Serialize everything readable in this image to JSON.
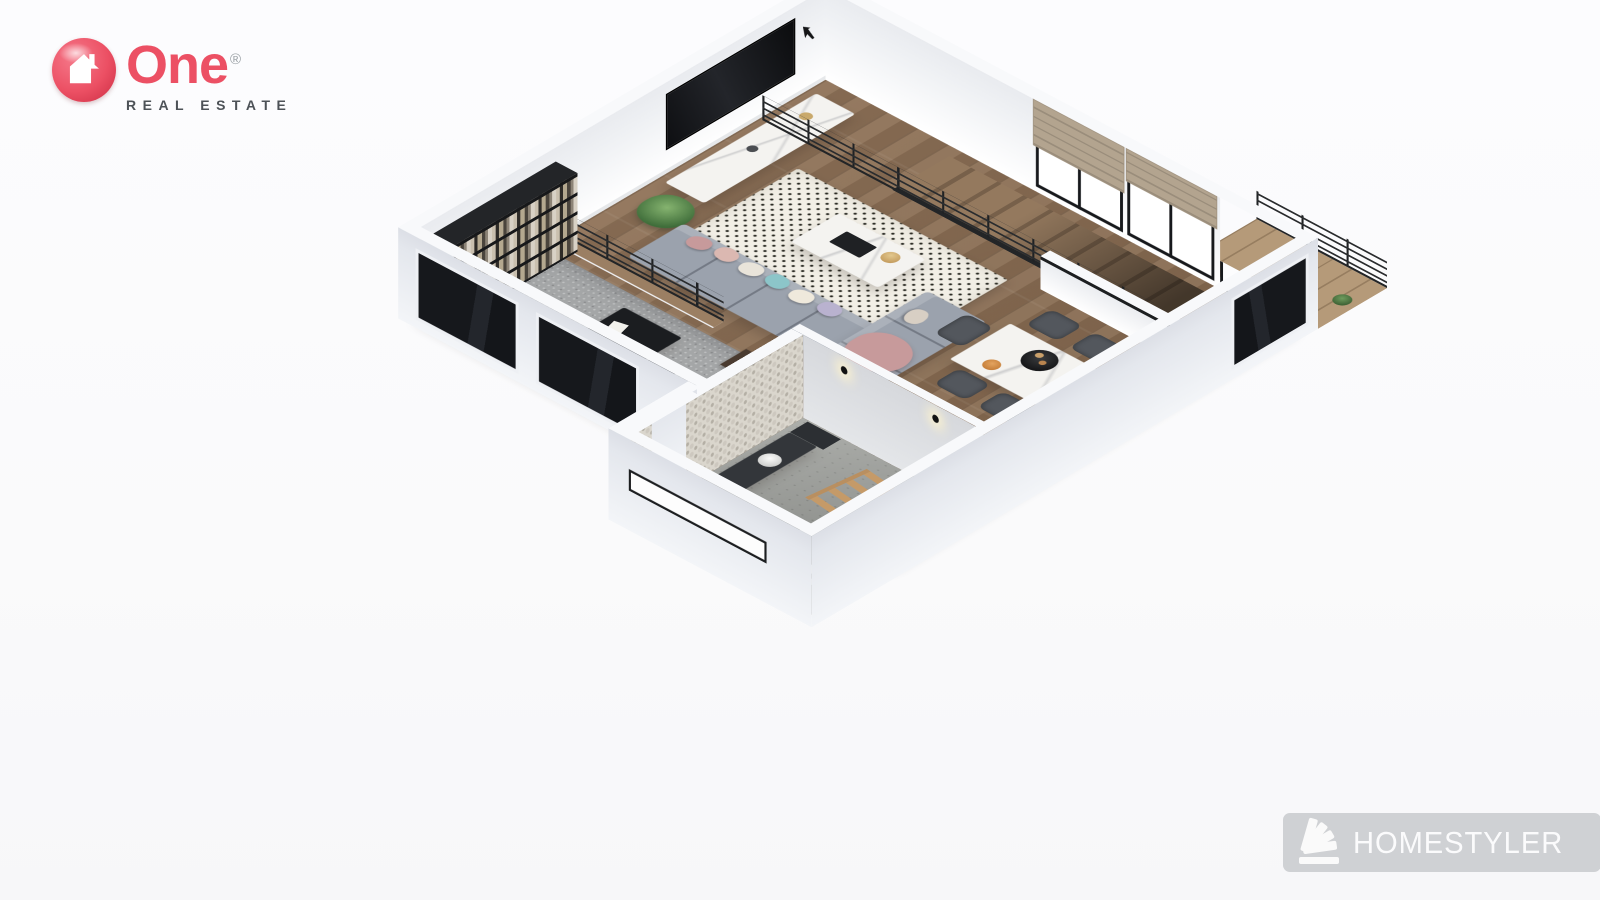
{
  "branding": {
    "logo": {
      "name": "One",
      "registered": "®",
      "tagline": "REAL ESTATE",
      "accent_color": "#ec5064",
      "tagline_color": "#4d5257",
      "icon": "house-arrow-circle-icon"
    },
    "watermark": {
      "label": "HOMESTYLER",
      "icon": "fan-swatch-icon",
      "bg_color": "#cbcdd0",
      "text_color": "#fbfbfc"
    }
  },
  "scene": {
    "type": "3d-floor-plan-render",
    "view": "axonometric dollhouse view, plan rotated about 45 degrees",
    "rooms": [
      {
        "id": "living-room",
        "items": [
          "wall-mounted-tv",
          "wall-decal-arrow",
          "media-console",
          "palm-plant",
          "dotted-area-rug",
          "gray-sectional-sofa",
          "chaise",
          "throw-pillows",
          "rose-blanket",
          "marble-coffee-table",
          "decor-books",
          "gold-bowl"
        ]
      },
      {
        "id": "dining-area",
        "items": [
          "marble-dining-table",
          "dark-wicker-chairs-x5",
          "black-serving-tray",
          "fruit-plate",
          "half-wall-guard",
          "gold-decor-ladder"
        ]
      },
      {
        "id": "kitchen",
        "items": [
          "dark-counter-with-sink",
          "cooktop",
          "tall-counter",
          "fridge-cabinet",
          "white-cabinet"
        ]
      },
      {
        "id": "home-office",
        "items": [
          "black-bookshelf-wall",
          "black-desk",
          "desk-papers",
          "office-chair",
          "shag-rug",
          "brown-side-cabinet",
          "step-down",
          "slippers"
        ]
      },
      {
        "id": "bathroom",
        "items": [
          "pebble-accent-wall",
          "dark-vanity",
          "round-sink",
          "wooden-ladder-shelf",
          "dark-stove-unit",
          "floor-vases",
          "dark-tub",
          "wall-lamps",
          "slit-window",
          "door-threshold"
        ]
      },
      {
        "id": "stairs",
        "items": [
          "upper-flight-along-windows",
          "cable-railing",
          "floor-opening",
          "black-baluster-railing"
        ]
      },
      {
        "id": "balcony",
        "items": [
          "wood-deck",
          "potted-plants",
          "cable-railing",
          "low-glass-wall",
          "roman-shade-windows"
        ]
      }
    ],
    "colors": {
      "background": "#fbfbfd",
      "wood": "#8d7158",
      "deck": "#b59a79",
      "wall_inner": "#f6f7f9",
      "wall_outer": "#e7eaef",
      "wall_top": "#f8f9fb",
      "carpet": "#a4a6a7",
      "concrete": "#a3a5a1",
      "rug": "#f2efe6",
      "sofa": "#9ba2ad",
      "chair": "#53575d",
      "counter": "#3a3d42",
      "black_furniture": "#1b1d20",
      "marble": "#f4f3f0",
      "railing": "#232527",
      "ladder_wood": "#bf9463",
      "plant": "#4e7d46",
      "shade": "#b3a48f",
      "window_frame": "#17191c"
    }
  }
}
